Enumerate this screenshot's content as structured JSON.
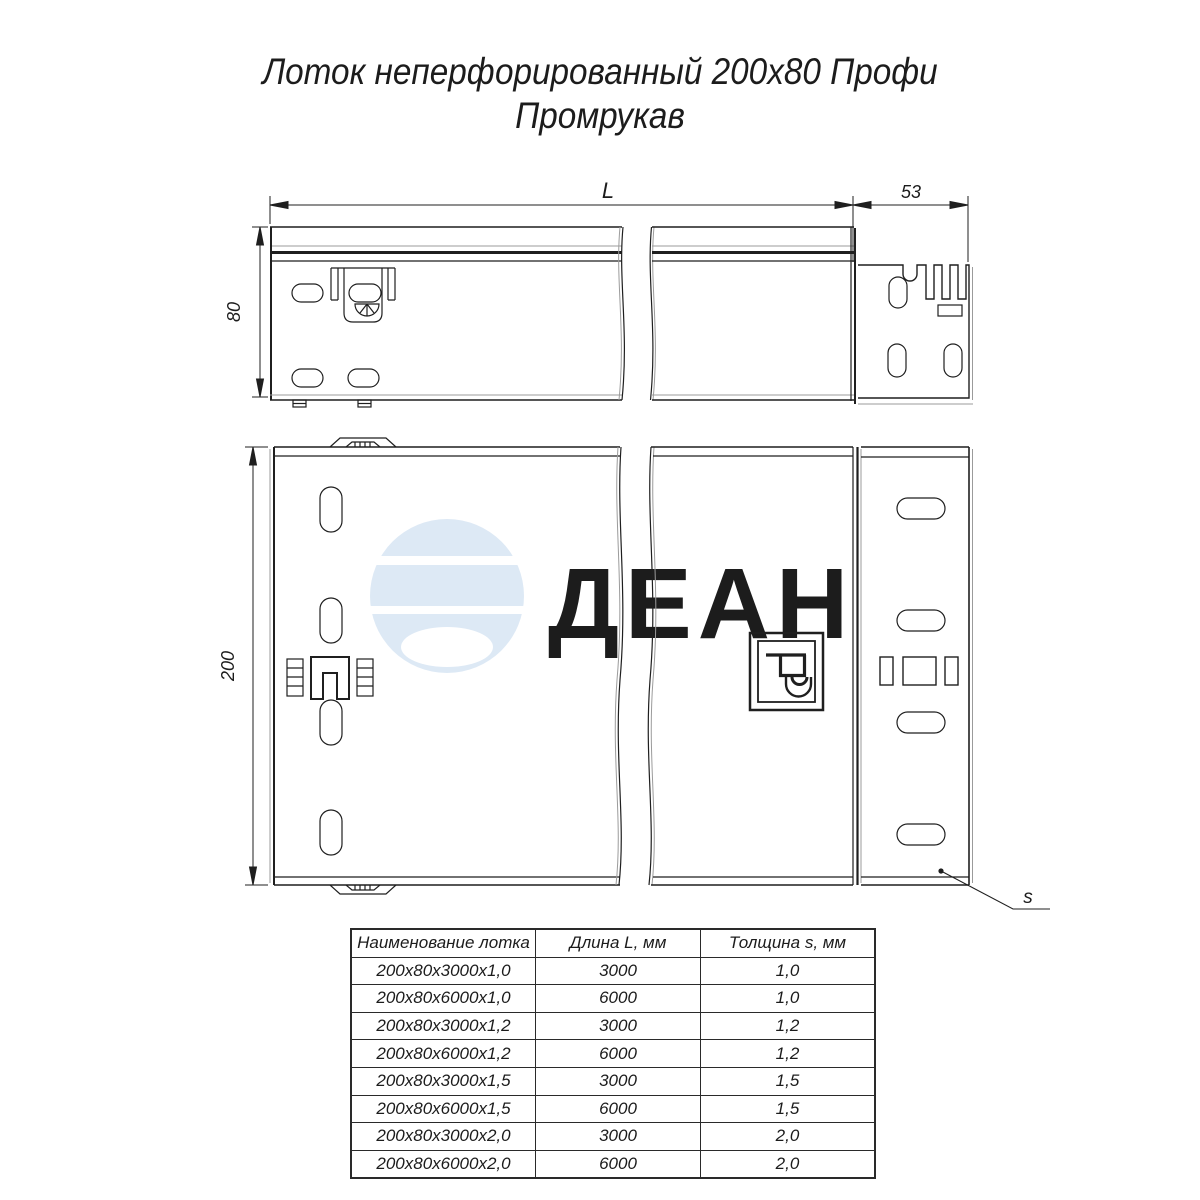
{
  "title": {
    "line1": "Лоток неперфорированный 200х80 Профи",
    "line2": "Промрукав"
  },
  "watermark": {
    "text": "ДЕАН",
    "color": "#dde9f5"
  },
  "dims": {
    "L": "L",
    "w53": "53",
    "h80": "80",
    "w200": "200",
    "s": "s"
  },
  "table": {
    "headers": [
      "Наименование лотка",
      "Длина L, мм",
      "Толщина s, мм"
    ],
    "rows": [
      [
        "200x80x3000x1,0",
        "3000",
        "1,0"
      ],
      [
        "200x80x6000x1,0",
        "6000",
        "1,0"
      ],
      [
        "200x80x3000x1,2",
        "3000",
        "1,2"
      ],
      [
        "200x80x6000x1,2",
        "6000",
        "1,2"
      ],
      [
        "200x80x3000x1,5",
        "3000",
        "1,5"
      ],
      [
        "200x80x6000x1,5",
        "6000",
        "1,5"
      ],
      [
        "200x80x3000x2,0",
        "3000",
        "2,0"
      ],
      [
        "200x80x6000x2,0",
        "6000",
        "2,0"
      ]
    ]
  },
  "colors": {
    "line": "#1f1f1f",
    "grey": "#9b9b9b",
    "watermark": "#dde9f5"
  }
}
